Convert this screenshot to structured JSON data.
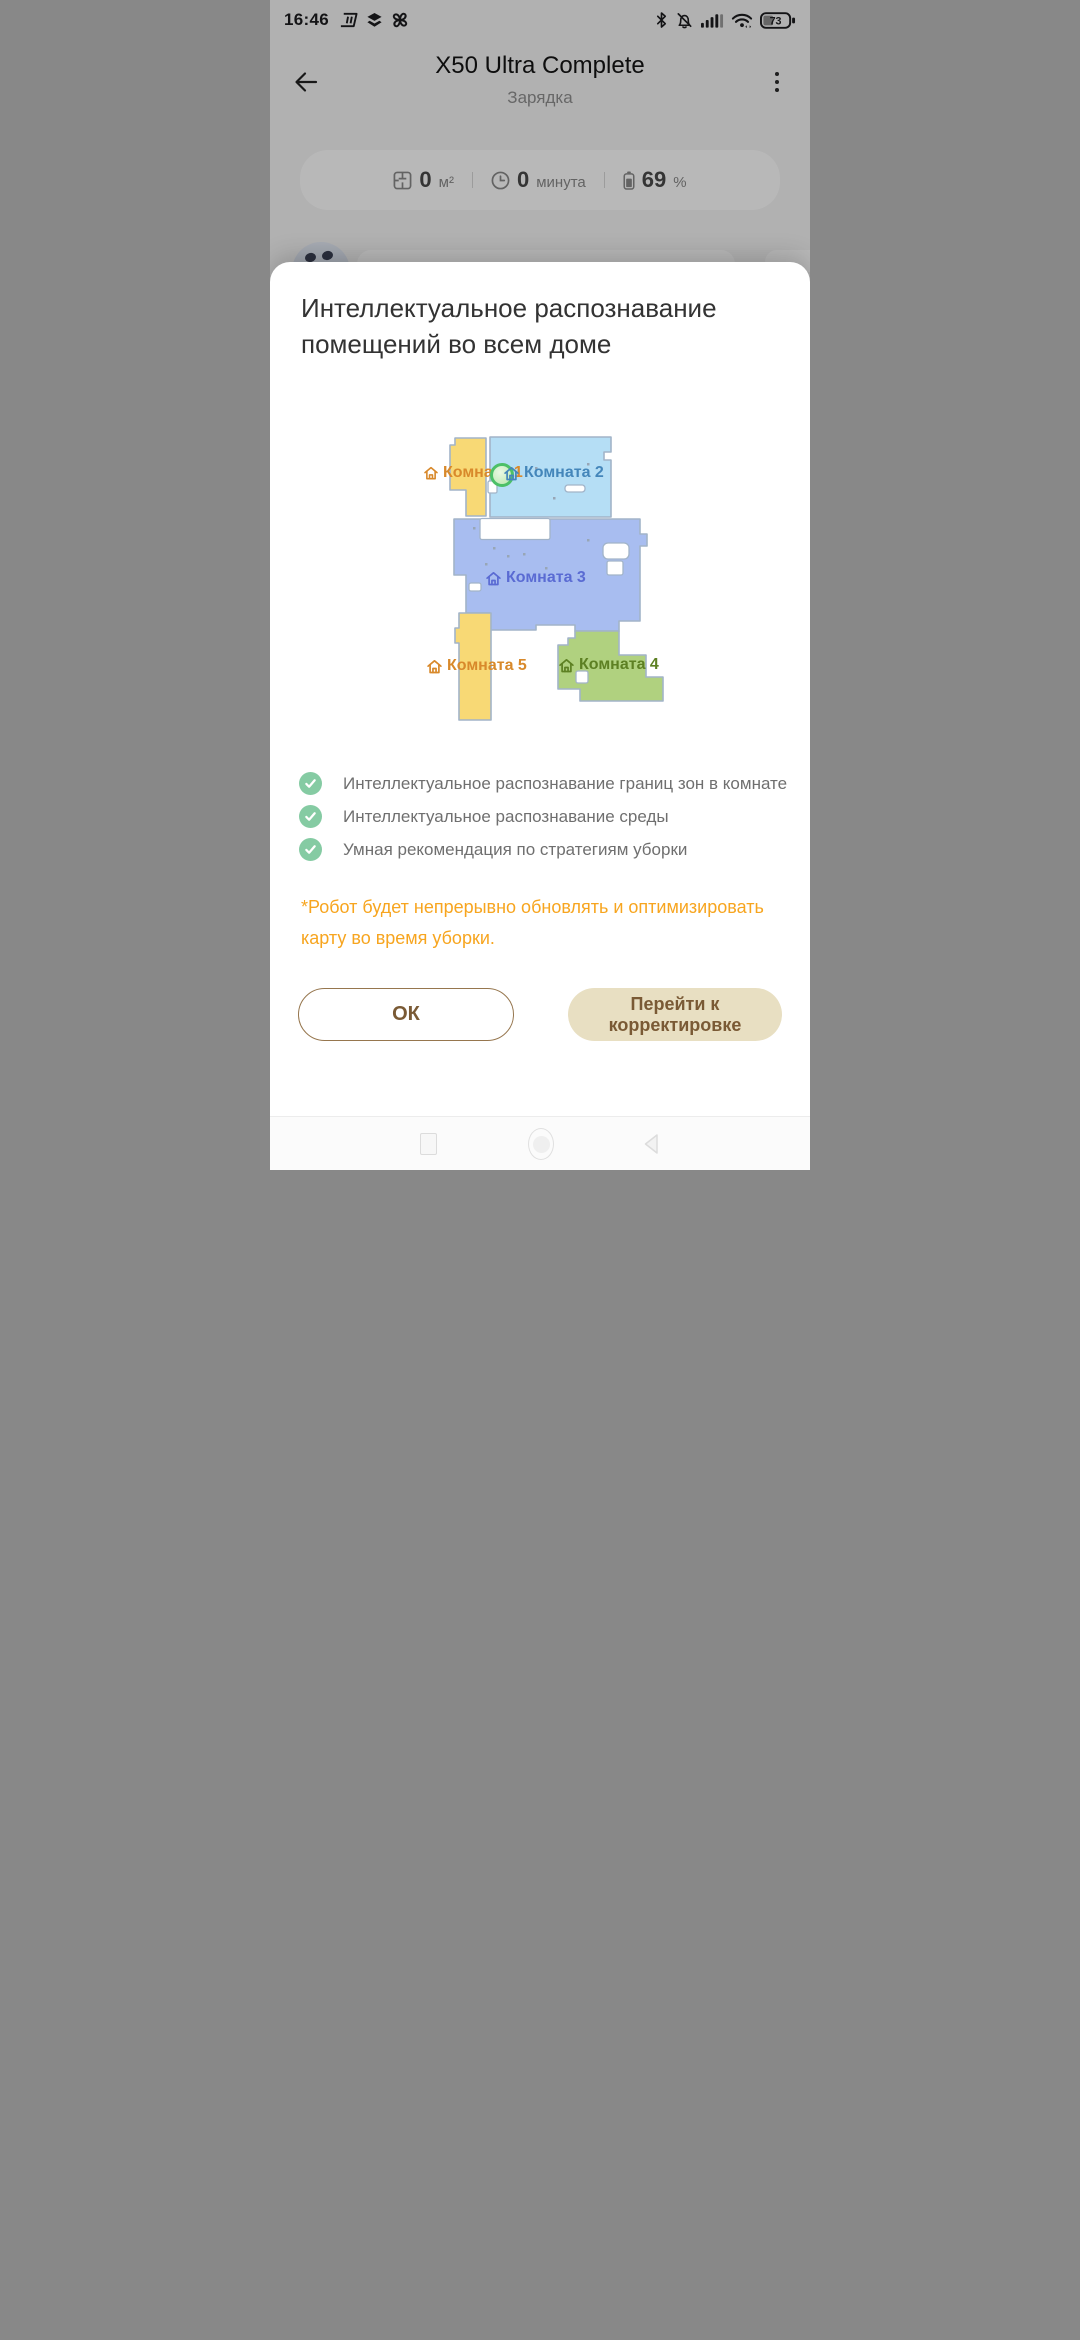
{
  "status_bar": {
    "time": "16:46",
    "battery_percent": "73"
  },
  "header": {
    "title": "X50 Ultra Complete",
    "status": "Зарядка"
  },
  "stats": {
    "area": {
      "value": "0",
      "unit": "м²"
    },
    "duration": {
      "value": "0",
      "unit": "минута"
    },
    "battery": {
      "value": "69",
      "unit": "%"
    }
  },
  "sheet": {
    "title": "Интеллектуальное распознавание помещений во всем доме",
    "features": [
      "Интеллектуальное распознавание границ зон в комнате",
      "Интеллектуальное распознавание среды",
      "Умная рекомендация по стратегиям уборки"
    ],
    "note": "*Робот будет непрерывно обновлять и оптимизировать карту во время уборки.",
    "ok_button": "ОК",
    "adjust_button": "Перейти к корректировке"
  },
  "map": {
    "rooms": [
      {
        "label": "Комната 1",
        "fill": "#f8d975",
        "label_color": "#d8892b"
      },
      {
        "label": "Комната 2",
        "fill": "#b5def5",
        "label_color": "#4486ba"
      },
      {
        "label": "Комната 3",
        "fill": "#a8bdf0",
        "label_color": "#5a6bd3"
      },
      {
        "label": "Комната 4",
        "fill": "#b0d17f",
        "label_color": "#5d8023"
      },
      {
        "label": "Комната 5",
        "fill": "#f8d975",
        "label_color": "#d8892b"
      }
    ],
    "wall_color": "#a2b4c8",
    "dock_color": "#4cc068"
  }
}
